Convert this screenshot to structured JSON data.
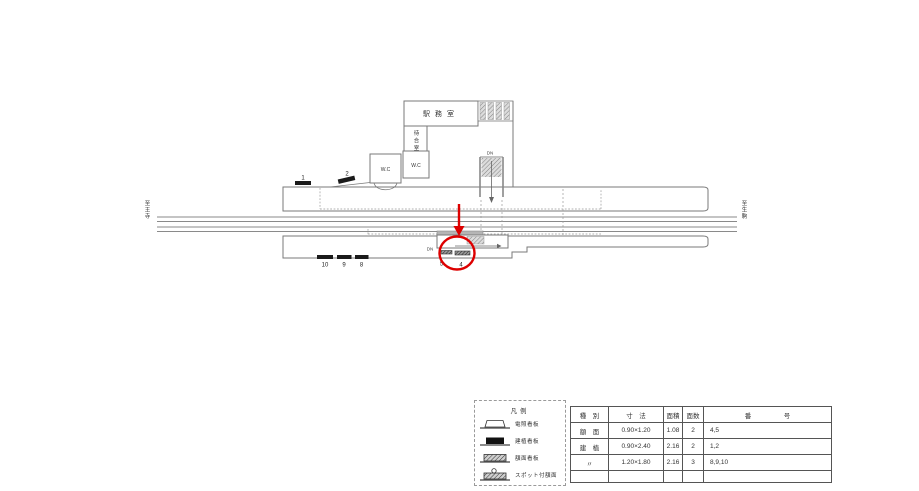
{
  "colors": {
    "annotation_red": "#dd0000",
    "line_gray": "#8a8a8a",
    "sign_black": "#1a1a1a"
  },
  "station": {
    "direction_left": "至王寺",
    "direction_right": "至生駒",
    "office": "駅務室",
    "waiting_room": "待合室",
    "wc_left": "W.C",
    "wc_right": "W.C",
    "stairs_upper": "DN",
    "stairs_lower": "DN",
    "signs": {
      "s1": "1",
      "s2": "2",
      "s4": "4",
      "s5": "5",
      "s8": "8",
      "s9": "9",
      "s10": "10"
    }
  },
  "legend": {
    "title": "凡例",
    "items": [
      {
        "label": "電照看板"
      },
      {
        "label": "建植看板"
      },
      {
        "label": "額面看板"
      },
      {
        "label": "スポット付額面"
      }
    ]
  },
  "table": {
    "headers": [
      "種　別",
      "寸　法",
      "面積",
      "面数",
      "番　　　　　号"
    ],
    "rows": [
      {
        "type": "額　面",
        "size": "0.90×1.20",
        "area": "1.08",
        "faces": "2",
        "numbers": "4,5"
      },
      {
        "type": "建　植",
        "size": "0.90×2.40",
        "area": "2.16",
        "faces": "2",
        "numbers": "1,2"
      },
      {
        "type": "〃",
        "size": "1.20×1.80",
        "area": "2.16",
        "faces": "3",
        "numbers": "8,9,10"
      },
      {
        "type": "",
        "size": "",
        "area": "",
        "faces": "",
        "numbers": ""
      }
    ]
  }
}
